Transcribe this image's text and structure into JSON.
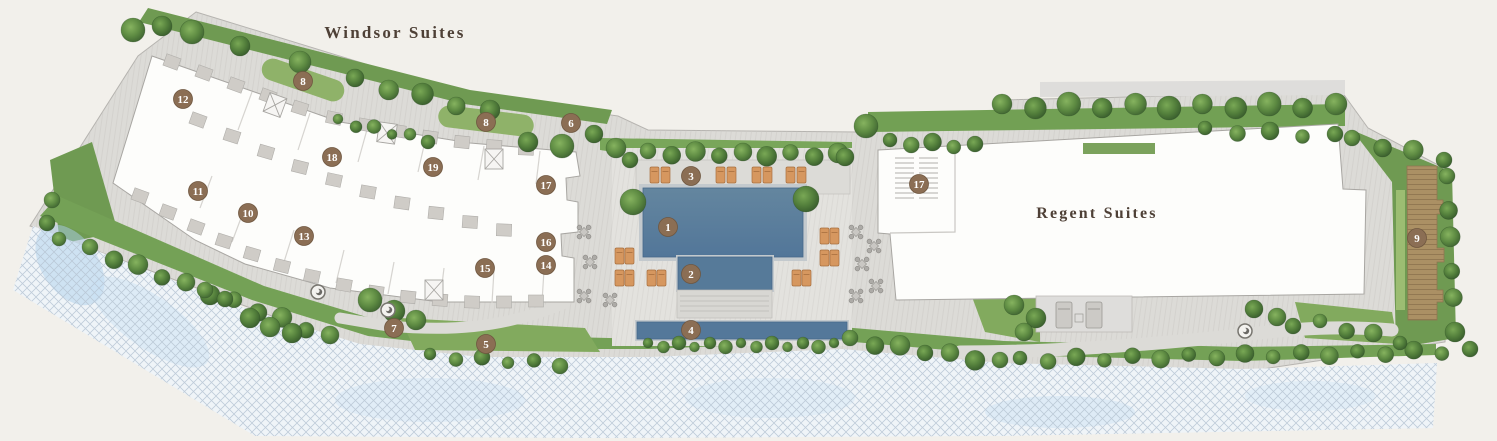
{
  "plan": {
    "labels": {
      "building_left": "Windsor Suites",
      "building_right": "Regent Suites"
    },
    "markers": [
      {
        "n": "1",
        "x": 668,
        "y": 227
      },
      {
        "n": "2",
        "x": 691,
        "y": 274
      },
      {
        "n": "3",
        "x": 691,
        "y": 176
      },
      {
        "n": "4",
        "x": 691,
        "y": 330
      },
      {
        "n": "5",
        "x": 486,
        "y": 344
      },
      {
        "n": "6",
        "x": 571,
        "y": 123
      },
      {
        "n": "7",
        "x": 394,
        "y": 328
      },
      {
        "n": "8",
        "x": 303,
        "y": 81
      },
      {
        "n": "8",
        "x": 486,
        "y": 122
      },
      {
        "n": "9",
        "x": 1417,
        "y": 238
      },
      {
        "n": "10",
        "x": 248,
        "y": 213
      },
      {
        "n": "11",
        "x": 198,
        "y": 191
      },
      {
        "n": "12",
        "x": 183,
        "y": 99
      },
      {
        "n": "13",
        "x": 304,
        "y": 236
      },
      {
        "n": "14",
        "x": 546,
        "y": 265
      },
      {
        "n": "15",
        "x": 485,
        "y": 268
      },
      {
        "n": "16",
        "x": 546,
        "y": 242
      },
      {
        "n": "17",
        "x": 546,
        "y": 185
      },
      {
        "n": "17",
        "x": 919,
        "y": 184
      },
      {
        "n": "18",
        "x": 332,
        "y": 157
      },
      {
        "n": "19",
        "x": 433,
        "y": 167
      }
    ],
    "colors": {
      "background": "#f2f0eb",
      "paving": "#dcdbd7",
      "paving_stripe": "#cbc9c5",
      "building": "#fdfdfb",
      "building_outline": "#a8a6a2",
      "pool": "#5d81a0",
      "pool_reflect": "#54789a",
      "lawn": "#74a156",
      "hedge": "#8fb269",
      "tree_dark": "#3c6030",
      "tree_light": "#86b35f",
      "beach": "#eff4f8",
      "beach_hatch": "#b7c5d3",
      "wood_deck": "#a98e62",
      "lounger": "#d6975f",
      "marker": "#8b6e54",
      "label_text": "#4e4036"
    }
  }
}
